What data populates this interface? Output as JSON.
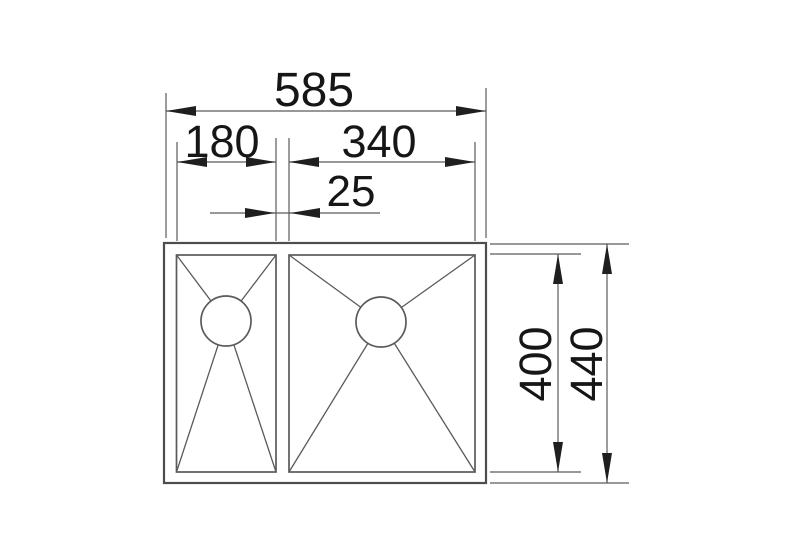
{
  "drawing": {
    "kind": "technical dimension drawing",
    "subject": "double bowl kitchen sink, top view",
    "units": "mm"
  },
  "labels": {
    "overall_width": "585",
    "left_bowl_width": "180",
    "right_bowl_width": "340",
    "gap_between_bowls": "25",
    "bowl_length": "400",
    "overall_length": "440"
  },
  "colors": {
    "background": "#ffffff",
    "outline": "#4d4d4d",
    "line": "#5a5a5a",
    "arrow": "#1f1f1f",
    "text": "#161616"
  }
}
